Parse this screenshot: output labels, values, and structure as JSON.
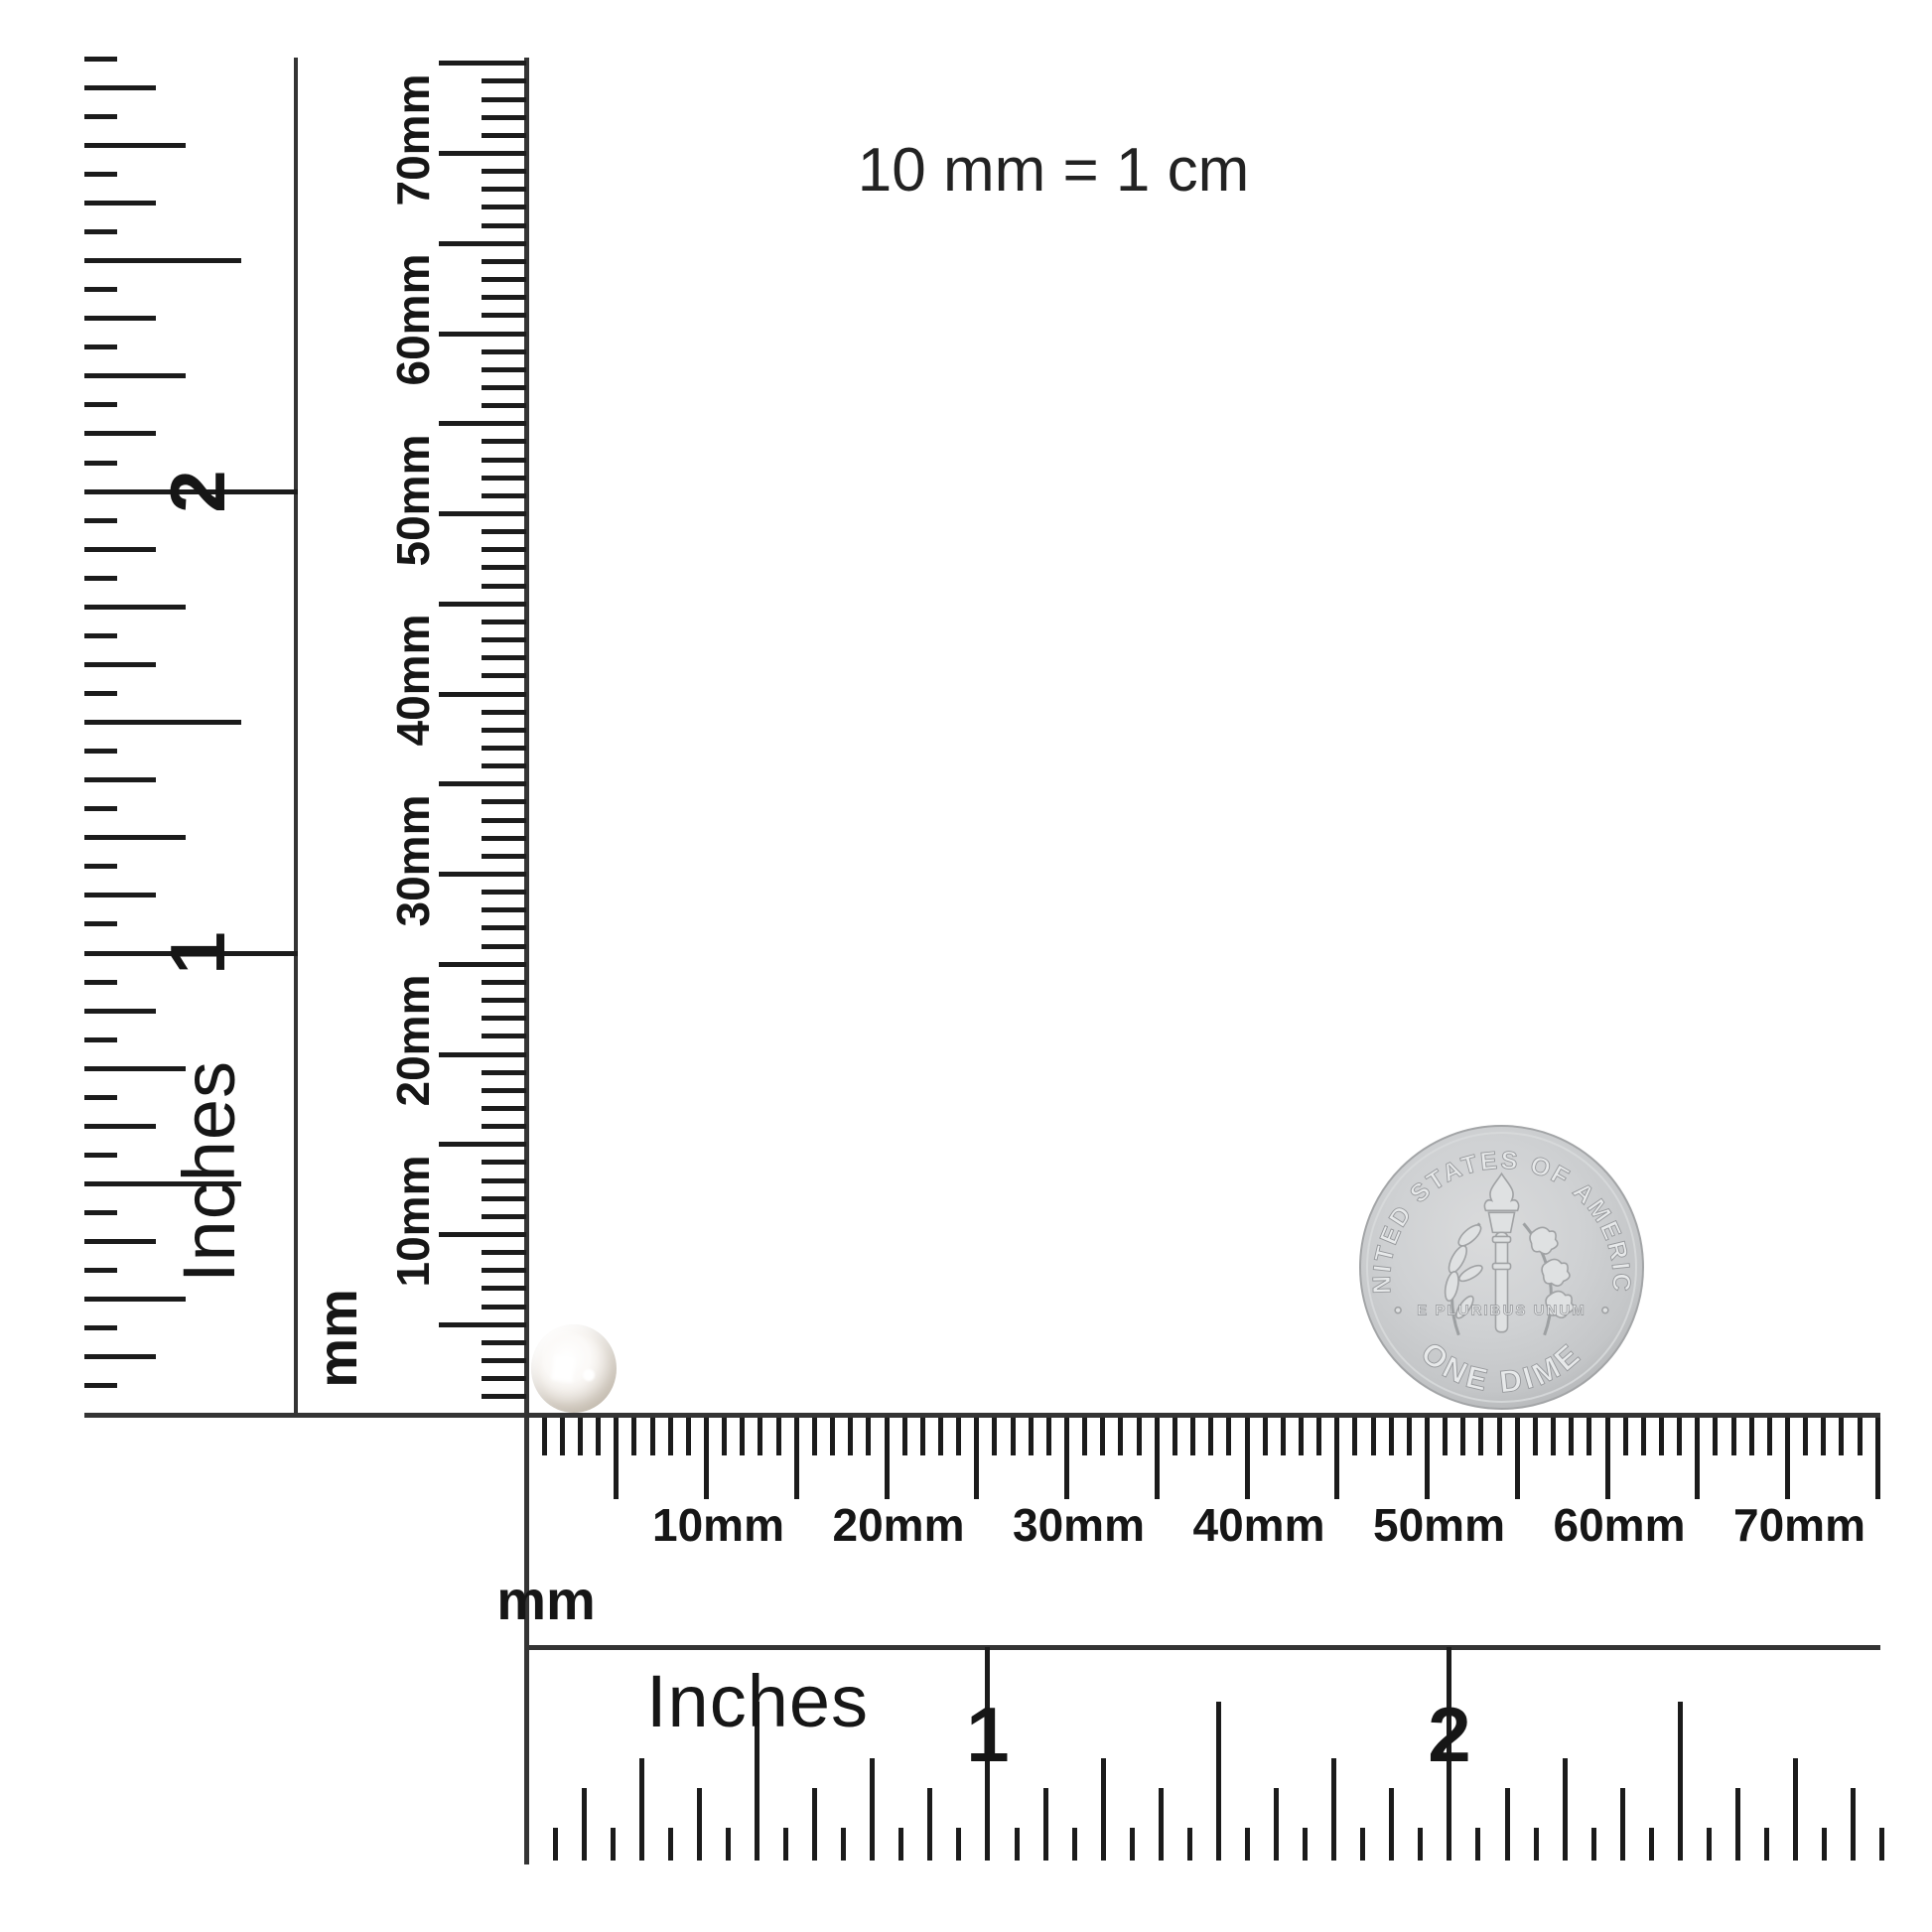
{
  "scale_note": {
    "text": "10 mm = 1 cm"
  },
  "rulers": {
    "left_inch": {
      "unit_label": "Inches",
      "numerals": [
        "1",
        "2"
      ]
    },
    "left_mm": {
      "unit_label": "mm",
      "tick_labels": [
        "10mm",
        "20mm",
        "30mm",
        "40mm",
        "50mm",
        "60mm",
        "70mm"
      ]
    },
    "bottom_mm": {
      "unit_label": "mm",
      "tick_labels": [
        "10mm",
        "20mm",
        "30mm",
        "40mm",
        "50mm",
        "60mm",
        "70mm"
      ]
    },
    "bottom_inch": {
      "unit_label": "Inches",
      "numerals": [
        "1",
        "2"
      ]
    }
  },
  "objects": {
    "pearl": {
      "label": "white pearl"
    },
    "dime": {
      "top_arc_text": "UNITED STATES OF AMERICA",
      "bottom_arc_text": "ONE DIME",
      "motto_text": "E PLURIBUS UNUM"
    }
  },
  "colors": {
    "background": "#ffffff",
    "tick": "#1b1b1b",
    "frame_line": "#343434",
    "text": "#161616",
    "coin_base": "#cbcdcf",
    "coin_detail_fill": "#e7e9ea",
    "coin_detail_stroke": "#97999c",
    "pearl_shade": "#cdc4b8"
  }
}
